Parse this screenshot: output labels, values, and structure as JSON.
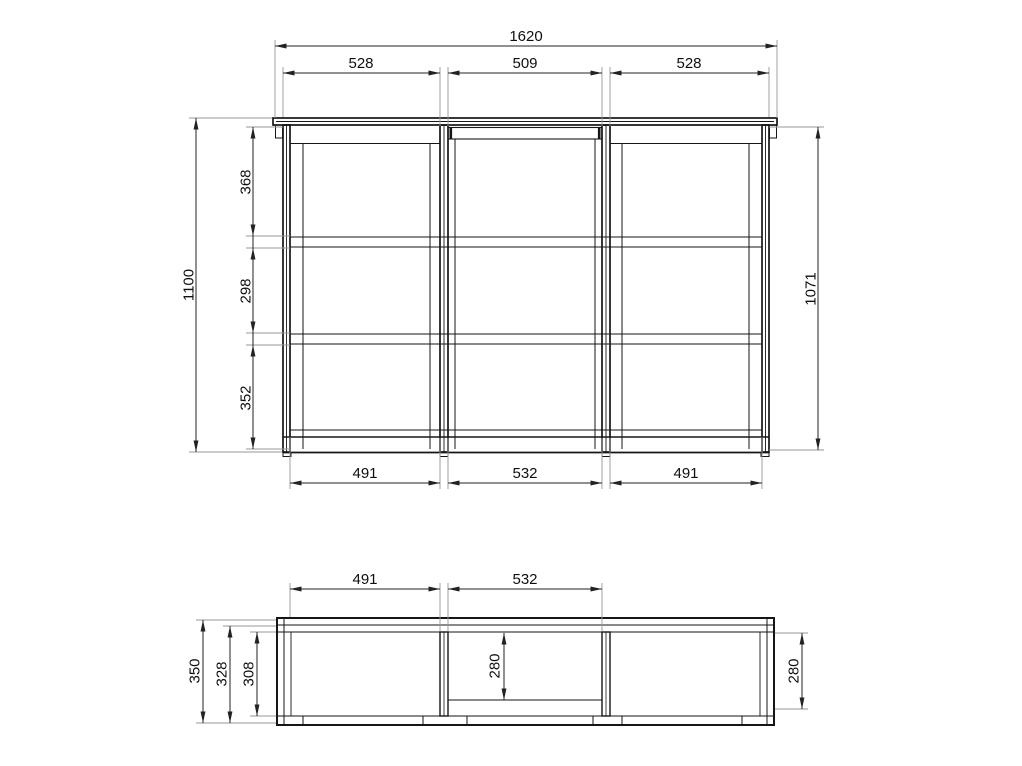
{
  "drawing": {
    "type": "furniture-technical-drawing",
    "views": [
      "front-elevation",
      "plan-section"
    ],
    "units": "mm",
    "line_color": "#161616",
    "dimension_color": "#222222",
    "extension_color": "#979797",
    "background": "#ffffff"
  },
  "front_view": {
    "total_width": "1620",
    "top_sections": [
      "528",
      "509",
      "528"
    ],
    "height_left": "1100",
    "inner_heights": [
      "368",
      "298",
      "352"
    ],
    "height_right": "1071",
    "bottom_widths": [
      "491",
      "532",
      "491"
    ]
  },
  "plan_view": {
    "top_widths": [
      "491",
      "532"
    ],
    "depths_left": [
      "350",
      "328",
      "308"
    ],
    "depth_middle": "280",
    "depth_right": "280"
  }
}
